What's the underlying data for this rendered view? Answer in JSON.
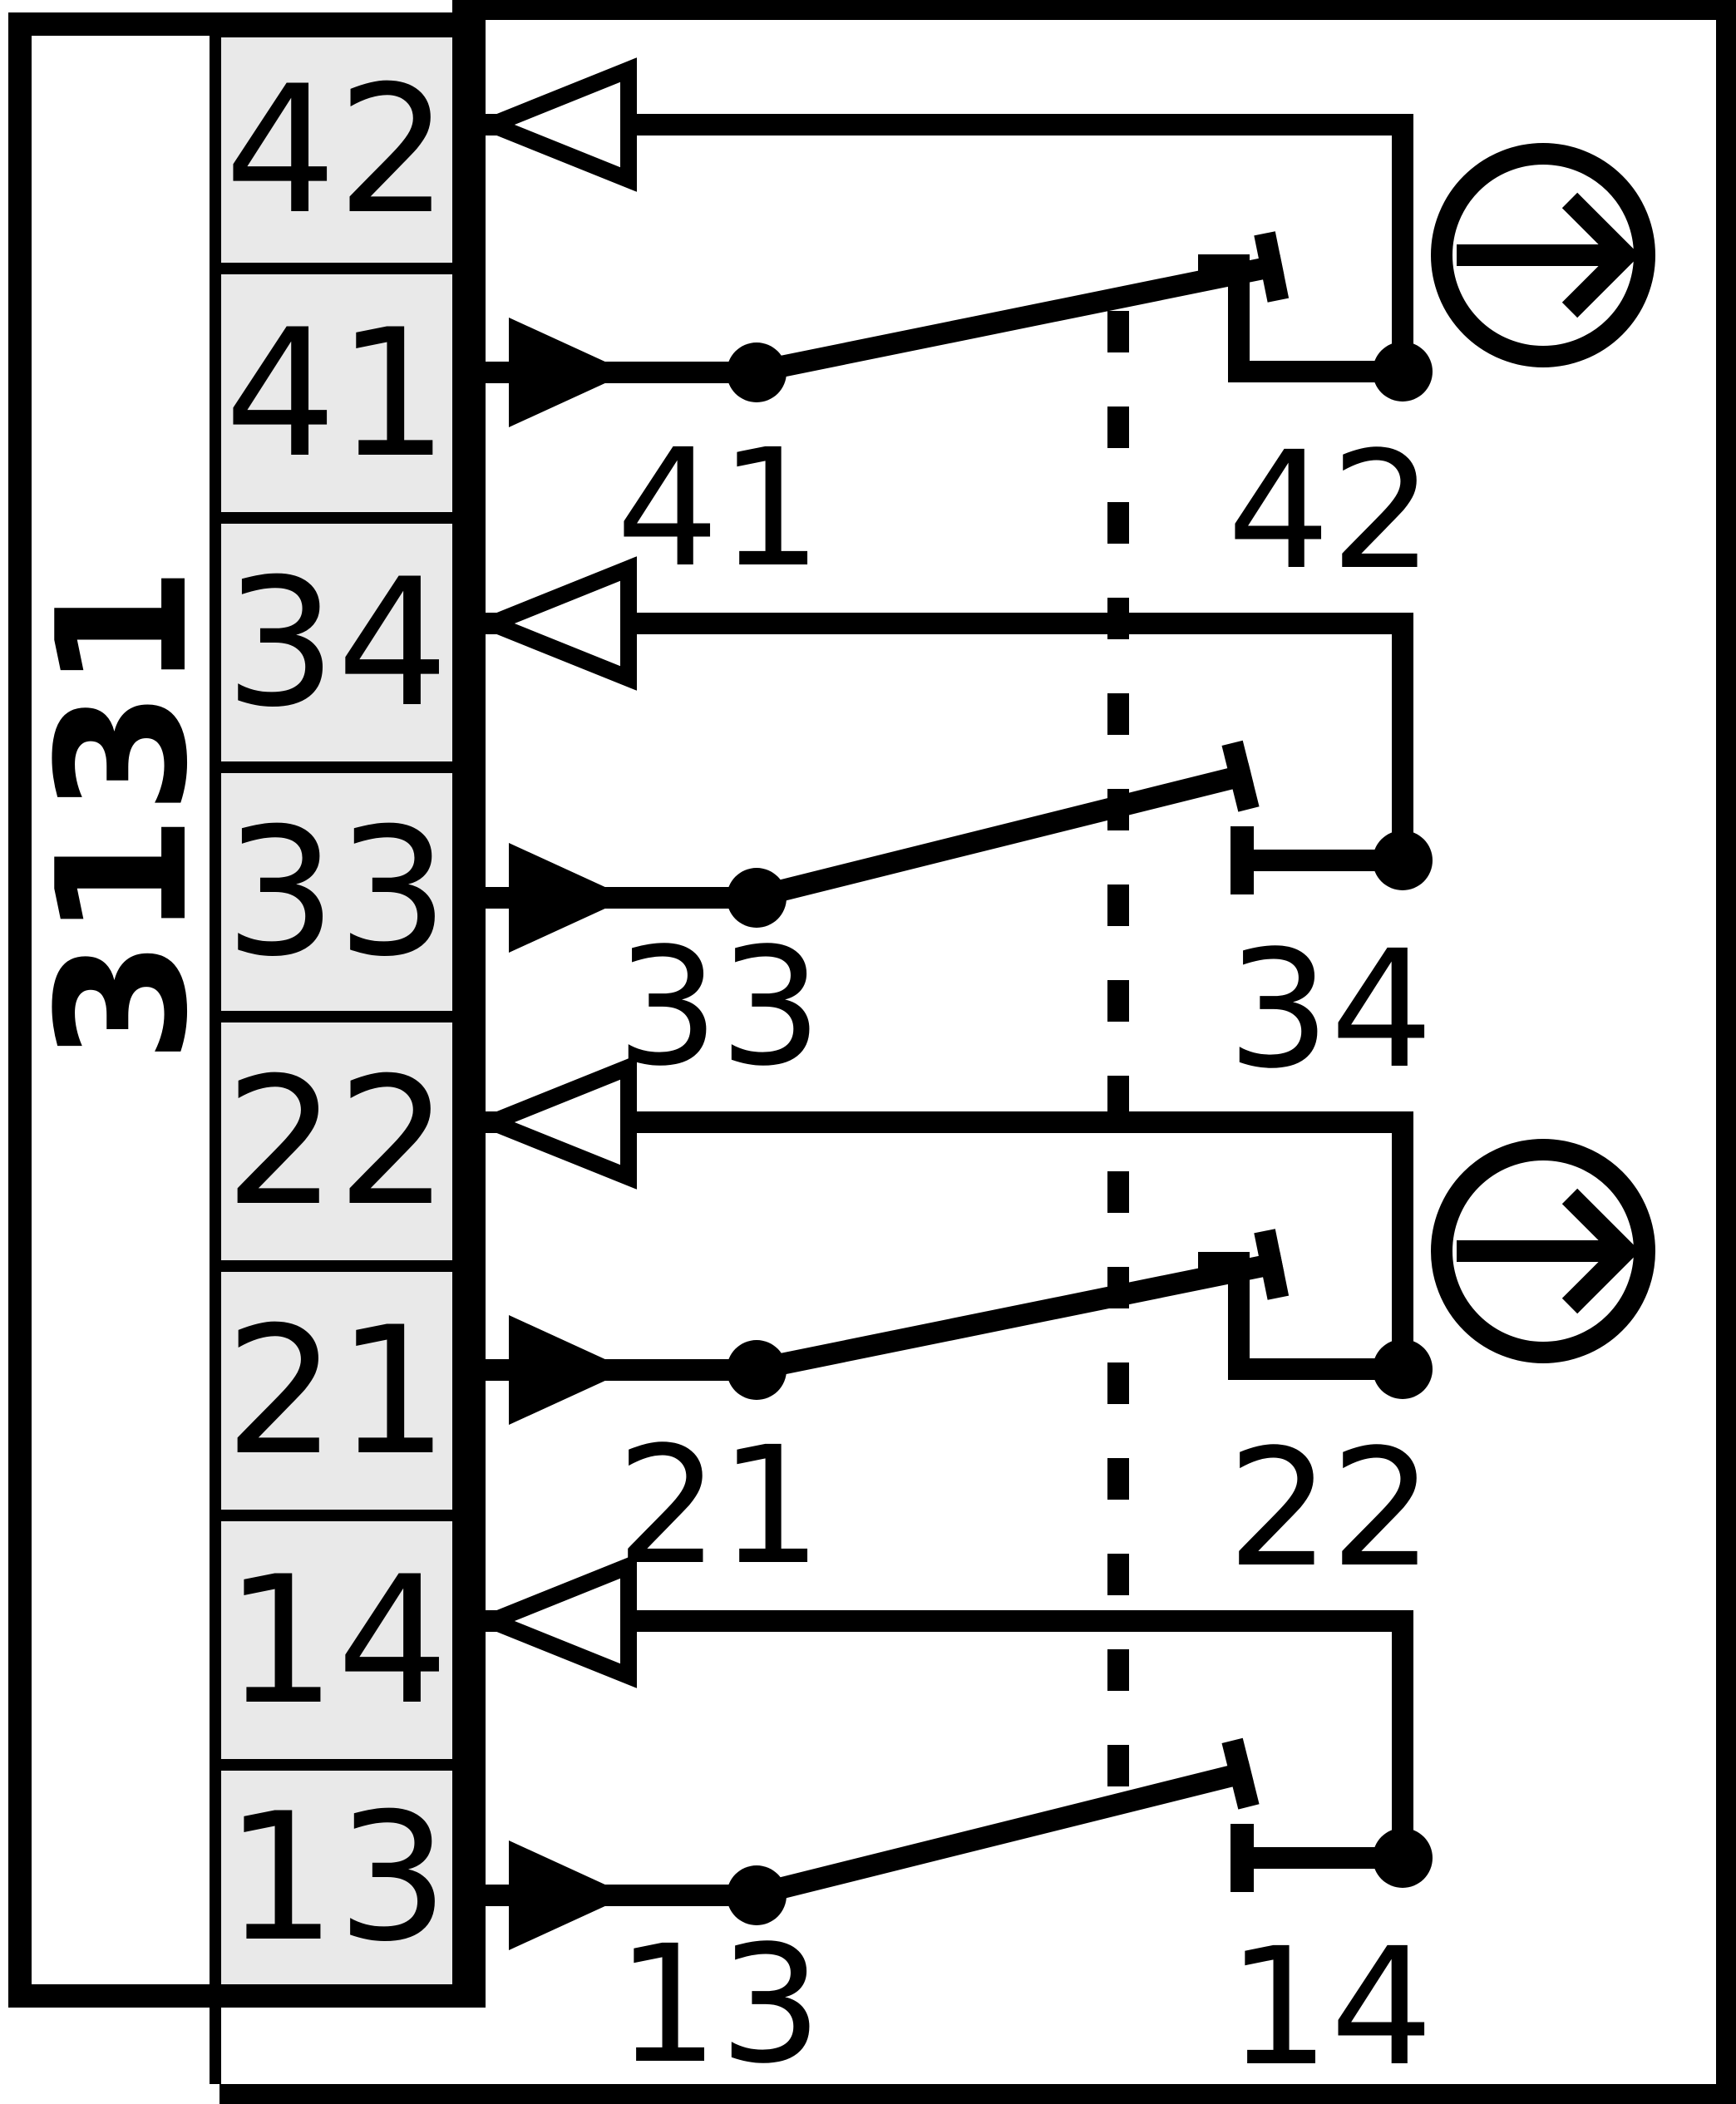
{
  "device": {
    "model": "3131"
  },
  "terminal_column": {
    "terminals": [
      {
        "id": "42"
      },
      {
        "id": "41"
      },
      {
        "id": "34"
      },
      {
        "id": "33"
      },
      {
        "id": "22"
      },
      {
        "id": "21"
      },
      {
        "id": "14"
      },
      {
        "id": "13"
      }
    ]
  },
  "contact_groups": [
    {
      "type": "NC",
      "movable_terminal": "41",
      "fixed_terminal": "42",
      "movable_label": "41",
      "fixed_label": "42"
    },
    {
      "type": "NO",
      "movable_terminal": "33",
      "fixed_terminal": "34",
      "movable_label": "33",
      "fixed_label": "34"
    },
    {
      "type": "NC",
      "movable_terminal": "21",
      "fixed_terminal": "22",
      "movable_label": "21",
      "fixed_label": "22"
    },
    {
      "type": "NO",
      "movable_terminal": "13",
      "fixed_terminal": "14",
      "movable_label": "13",
      "fixed_label": "14"
    }
  ],
  "icons": {
    "input_arrow": "filled-right-arrow",
    "output_arrow": "hollow-left-arrow",
    "actuation": "circle-right-arrow",
    "mechanical_link": "vertical-dashed-line"
  },
  "colors": {
    "line": "#000000",
    "background": "#ffffff",
    "terminal_fill": "#e9e9e9"
  }
}
